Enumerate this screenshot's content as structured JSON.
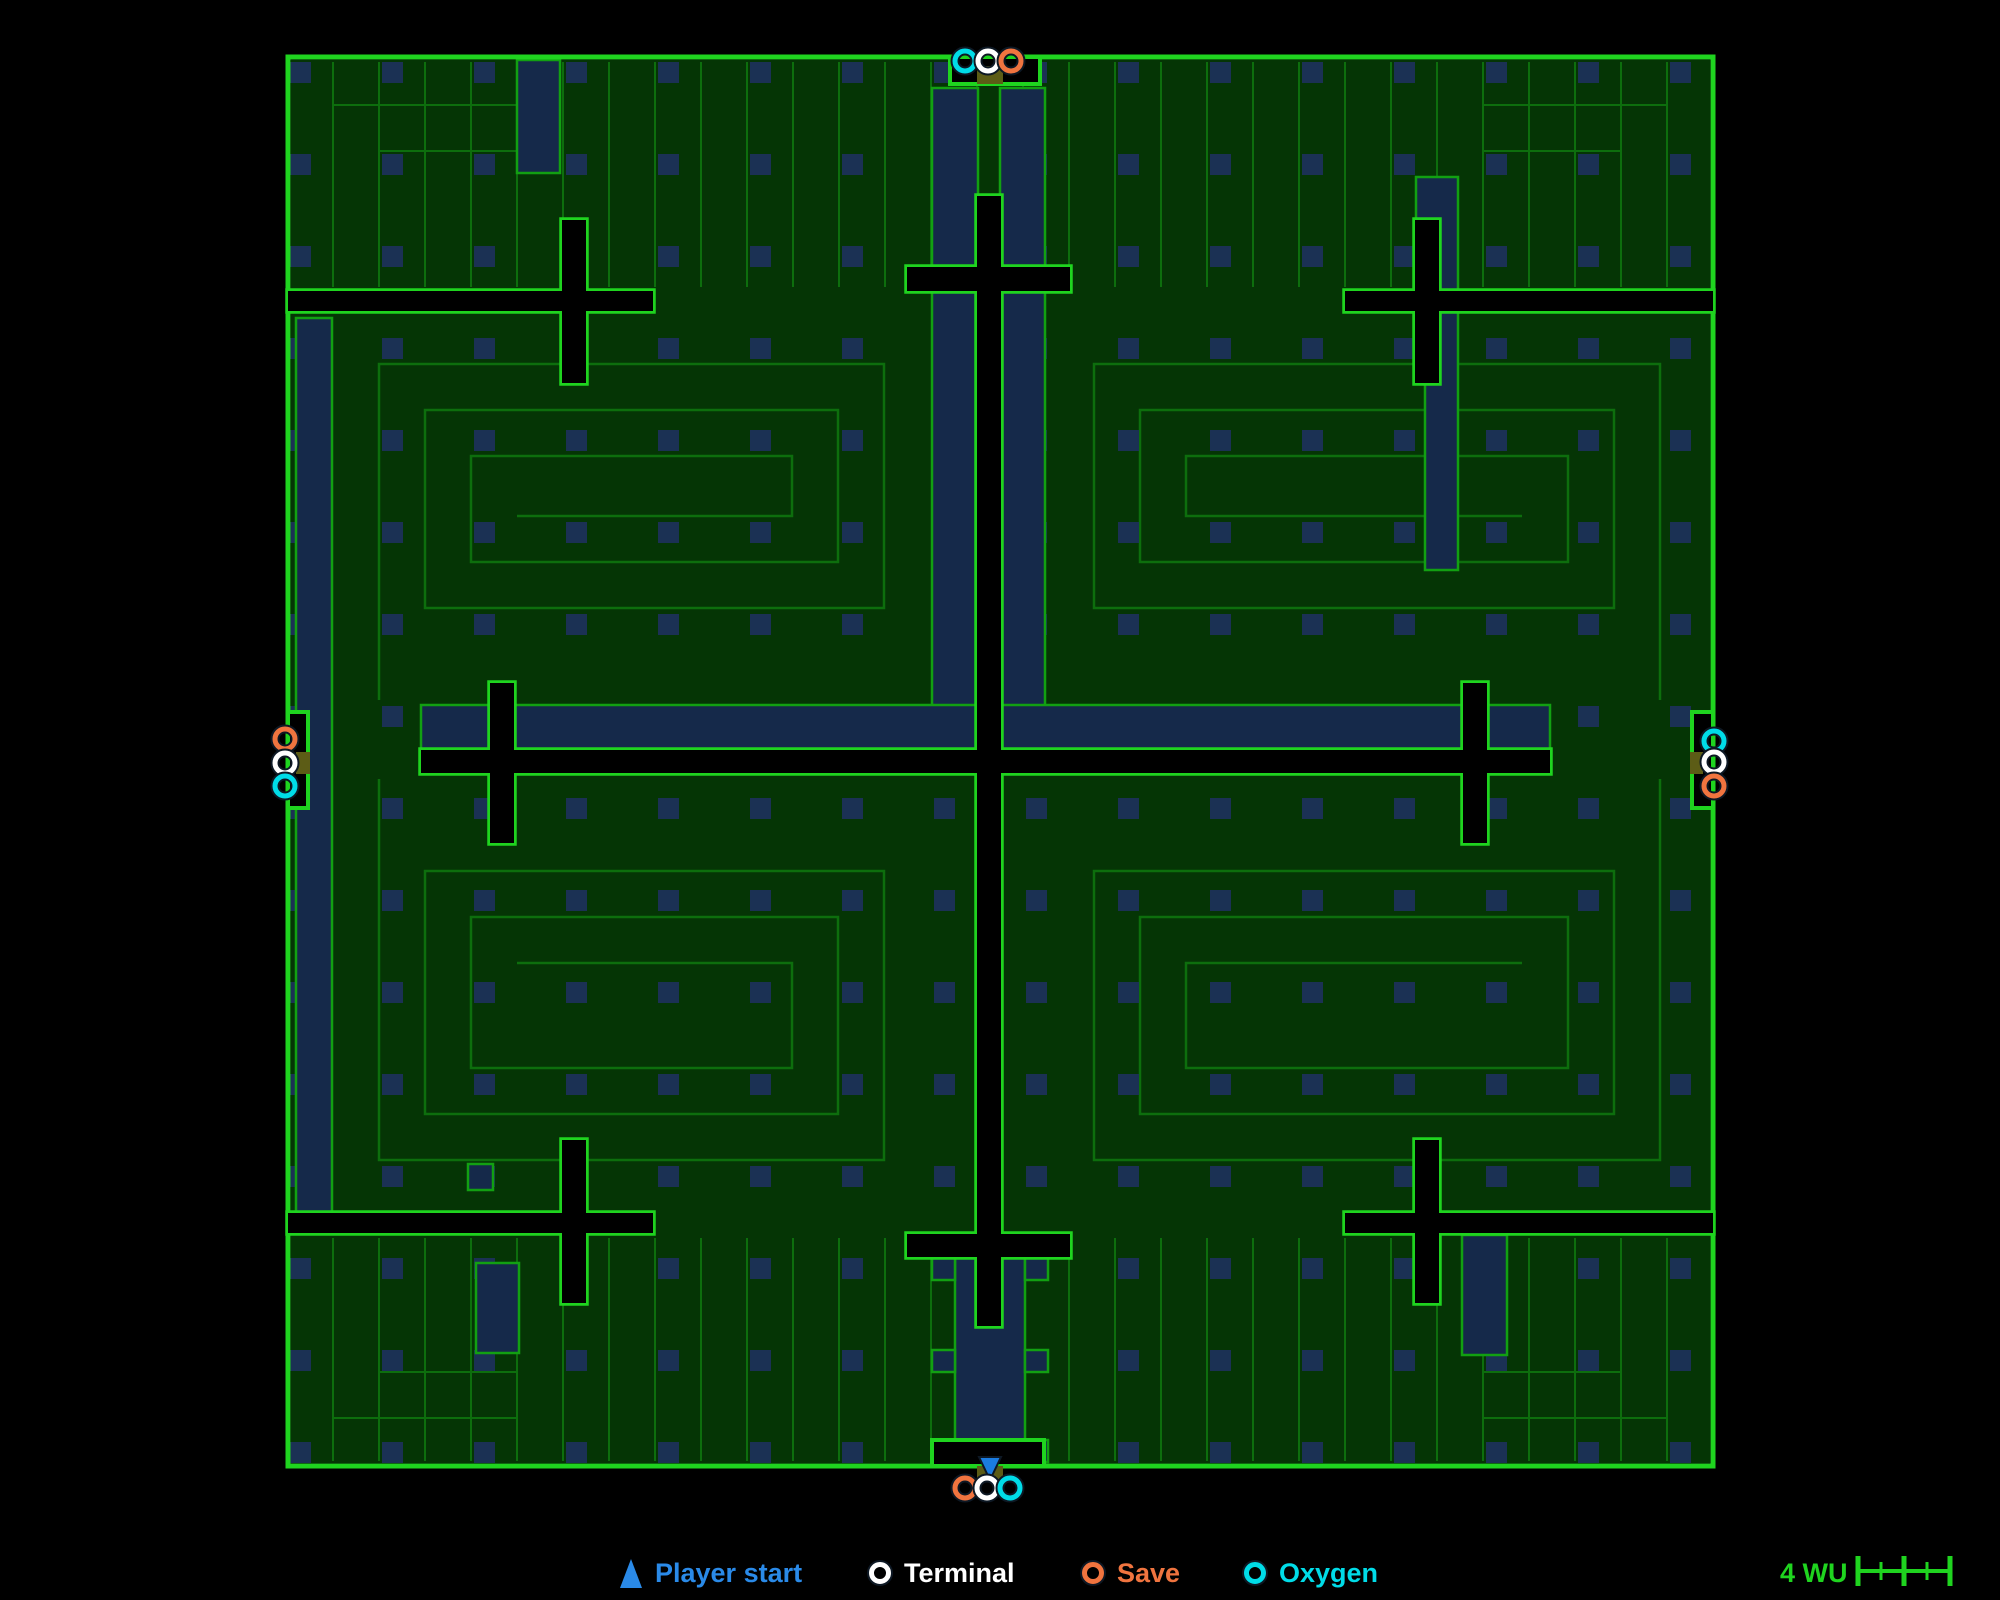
{
  "colors": {
    "background": "#000000",
    "room": "#053505",
    "wall_bright": "#1fd41f",
    "wall_mid": "#12a012",
    "wall_dim": "#0d6e0d",
    "corridor": "#15294a",
    "dot": "#1b3154",
    "door": "#5c5c16",
    "void": "#000000",
    "halo": "#0d1824"
  },
  "marker_colors": {
    "oxygen": "#00dce8",
    "terminal": "#ffffff",
    "save": "#f0743f",
    "player": "#1b7ce0"
  },
  "map": {
    "x": 288,
    "y": 57,
    "w": 1425,
    "h": 1409
  },
  "grid": {
    "x0": 290,
    "y0": 62,
    "step": 92,
    "size": 21,
    "nx": 16,
    "ny": 16
  },
  "maze": {
    "step": 46,
    "quadrants": [
      {
        "box": [
          333,
          318,
          930,
          700
        ],
        "mirror_x": false,
        "mirror_y": false
      },
      {
        "box": [
          1048,
          318,
          1706,
          700
        ],
        "mirror_x": true,
        "mirror_y": false
      },
      {
        "box": [
          333,
          779,
          930,
          1206
        ],
        "mirror_x": false,
        "mirror_y": true
      },
      {
        "box": [
          1048,
          779,
          1706,
          1206
        ],
        "mirror_x": true,
        "mirror_y": true
      }
    ],
    "stripe_bands": [
      {
        "x0": 333,
        "x1": 1706,
        "y0": 62,
        "y1": 287,
        "step": 46
      },
      {
        "x0": 333,
        "x1": 1706,
        "y0": 1238,
        "y1": 1461,
        "step": 46
      }
    ],
    "extra_lines": [
      [
        333,
        105,
        517,
        105
      ],
      [
        378,
        151,
        517,
        151
      ],
      [
        1482,
        105,
        1666,
        105
      ],
      [
        1482,
        151,
        1621,
        151
      ],
      [
        333,
        1418,
        517,
        1418
      ],
      [
        378,
        1372,
        517,
        1372
      ],
      [
        1482,
        1418,
        1666,
        1418
      ],
      [
        1482,
        1372,
        1621,
        1372
      ]
    ]
  },
  "corridors": [
    {
      "name": "west-column",
      "rect": [
        296,
        318,
        36,
        894
      ]
    },
    {
      "name": "north-shaft-left",
      "rect": [
        932,
        88,
        46,
        662
      ]
    },
    {
      "name": "north-shaft-right",
      "rect": [
        1000,
        88,
        45,
        662
      ]
    },
    {
      "name": "center-moat-west",
      "rect": [
        421,
        705,
        557,
        45
      ]
    },
    {
      "name": "center-moat-east",
      "rect": [
        1000,
        705,
        550,
        45
      ]
    },
    {
      "name": "south-shaft",
      "rect": [
        955,
        1256,
        70,
        206
      ]
    },
    {
      "name": "south-shaft-tab",
      "rect": [
        932,
        1258,
        23,
        22
      ]
    },
    {
      "name": "south-shaft-tab",
      "rect": [
        1025,
        1258,
        23,
        22
      ]
    },
    {
      "name": "south-shaft-tab",
      "rect": [
        932,
        1350,
        23,
        22
      ]
    },
    {
      "name": "south-shaft-tab",
      "rect": [
        1025,
        1350,
        23,
        22
      ]
    },
    {
      "name": "south-shaft-tab",
      "rect": [
        932,
        1440,
        23,
        22
      ]
    },
    {
      "name": "south-shaft-tab",
      "rect": [
        1025,
        1440,
        23,
        22
      ]
    },
    {
      "name": "ne-pocket",
      "rect": [
        1416,
        177,
        42,
        113
      ]
    },
    {
      "name": "ne-pocket-lower",
      "rect": [
        1425,
        312,
        33,
        258
      ]
    },
    {
      "name": "se-pocket",
      "rect": [
        1462,
        1235,
        45,
        120
      ]
    },
    {
      "name": "sw-pocket",
      "rect": [
        468,
        1164,
        25,
        26
      ]
    },
    {
      "name": "nw-band-pocket",
      "rect": [
        517,
        60,
        43,
        113
      ]
    },
    {
      "name": "sw-band-pocket",
      "rect": [
        476,
        1263,
        43,
        90
      ]
    }
  ],
  "voids": [
    {
      "name": "center-cross",
      "rects": [
        [
          977,
          196,
          24,
          1130
        ],
        [
          421,
          750,
          1129,
          23
        ],
        [
          907,
          267,
          163,
          24
        ],
        [
          907,
          1234,
          163,
          23
        ],
        [
          490,
          683,
          24,
          160
        ],
        [
          1463,
          683,
          24,
          160
        ]
      ]
    },
    {
      "name": "nw-cross",
      "rects": [
        [
          288,
          291,
          365,
          20
        ],
        [
          562,
          220,
          24,
          163
        ]
      ]
    },
    {
      "name": "ne-cross",
      "rects": [
        [
          1345,
          291,
          368,
          20
        ],
        [
          1415,
          220,
          24,
          163
        ]
      ]
    },
    {
      "name": "sw-cross",
      "rects": [
        [
          288,
          1213,
          365,
          20
        ],
        [
          562,
          1140,
          24,
          163
        ]
      ]
    },
    {
      "name": "se-cross",
      "rects": [
        [
          1345,
          1213,
          368,
          20
        ],
        [
          1415,
          1140,
          24,
          163
        ]
      ]
    }
  ],
  "doors": [
    {
      "side": "north",
      "notch": [
        950,
        57,
        90,
        27
      ],
      "door": [
        977,
        66,
        26,
        18
      ],
      "rings": [
        {
          "type": "oxygen",
          "x": 965,
          "y": 61
        },
        {
          "type": "terminal",
          "x": 988,
          "y": 61
        },
        {
          "type": "save",
          "x": 1011,
          "y": 61
        }
      ]
    },
    {
      "side": "west",
      "notch": [
        288,
        712,
        20,
        96
      ],
      "door": [
        296,
        752,
        14,
        22
      ],
      "rings": [
        {
          "type": "save",
          "x": 285,
          "y": 739
        },
        {
          "type": "terminal",
          "x": 285,
          "y": 763
        },
        {
          "type": "oxygen",
          "x": 285,
          "y": 786
        }
      ]
    },
    {
      "side": "east",
      "notch": [
        1692,
        712,
        21,
        96
      ],
      "door": [
        1690,
        752,
        13,
        22
      ],
      "rings": [
        {
          "type": "oxygen",
          "x": 1714,
          "y": 741
        },
        {
          "type": "terminal",
          "x": 1714,
          "y": 762
        },
        {
          "type": "save",
          "x": 1714,
          "y": 786
        }
      ]
    },
    {
      "side": "south",
      "notch": [
        932,
        1440,
        112,
        26
      ],
      "door": [
        977,
        1466,
        26,
        14
      ],
      "player_start": {
        "x": 990,
        "y": 1458
      },
      "rings": [
        {
          "type": "save",
          "x": 965,
          "y": 1488
        },
        {
          "type": "terminal",
          "x": 987,
          "y": 1488
        },
        {
          "type": "oxygen",
          "x": 1010,
          "y": 1488
        }
      ]
    }
  ],
  "legend": {
    "y": 1556,
    "items": [
      {
        "icon": "player-start",
        "label": "Player start",
        "color": "#2a8ae8",
        "x": 620
      },
      {
        "icon": "terminal",
        "label": "Terminal",
        "color": "#ffffff",
        "x": 869
      },
      {
        "icon": "save",
        "label": "Save",
        "color": "#f0743f",
        "x": 1082
      },
      {
        "icon": "oxygen",
        "label": "Oxygen",
        "color": "#00dce8",
        "x": 1244
      }
    ]
  },
  "scale_bar": {
    "label": "4 WU",
    "color": "#1fd41f",
    "ruler": {
      "y": 1571,
      "x0": 1858,
      "x1": 1950,
      "majors": [
        1858,
        1904,
        1950
      ],
      "minors": [
        1881,
        1927
      ],
      "major_h": 30,
      "minor_h": 18
    }
  }
}
